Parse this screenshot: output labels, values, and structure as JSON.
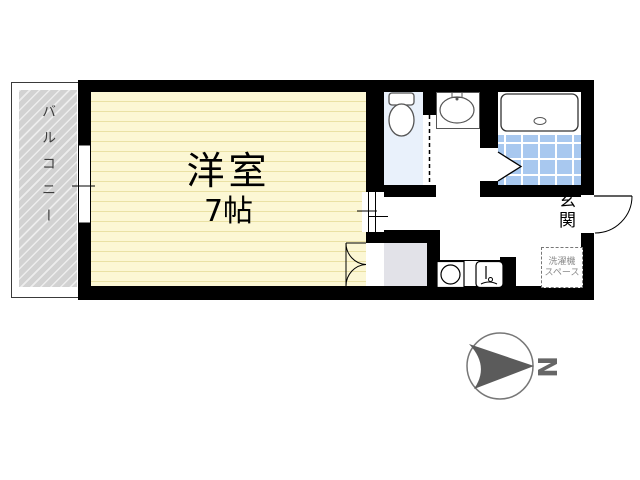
{
  "floorplan": {
    "labels": {
      "balcony": "バルコニー",
      "room_name": "洋室",
      "room_size": "7帖",
      "entrance": "玄関",
      "washer_line1": "洗濯機",
      "washer_line2": "スペース",
      "compass_north": "N"
    },
    "rooms": [
      {
        "name": "balcony",
        "label": "バルコニー"
      },
      {
        "name": "western-room",
        "label": "洋室",
        "size": "7帖"
      },
      {
        "name": "toilet",
        "label": ""
      },
      {
        "name": "washroom",
        "label": ""
      },
      {
        "name": "bathroom",
        "label": ""
      },
      {
        "name": "closet",
        "label": ""
      },
      {
        "name": "entrance",
        "label": "玄関"
      },
      {
        "name": "washer-space",
        "label": "洗濯機スペース"
      }
    ],
    "icons": {
      "toilet": "toilet-top-view",
      "washbasin": "oval-basin-with-faucet",
      "bathtub": "rounded-tub-with-drain",
      "stove": "single-burner-circle",
      "kitchen_sink": "square-sink-with-faucet",
      "compass": "north-arrow-in-circle"
    },
    "colors": {
      "wall": "#000000",
      "room_floor": "#fcf7d4",
      "room_floor_line": "#eae1a4",
      "balcony_floor": "#d2d2d2",
      "toilet_floor": "#e9f1fb",
      "bath_tile": "#a8c8ef",
      "closet_floor": "#e2e2e8",
      "compass_arrow": "#5b5b5b"
    }
  }
}
